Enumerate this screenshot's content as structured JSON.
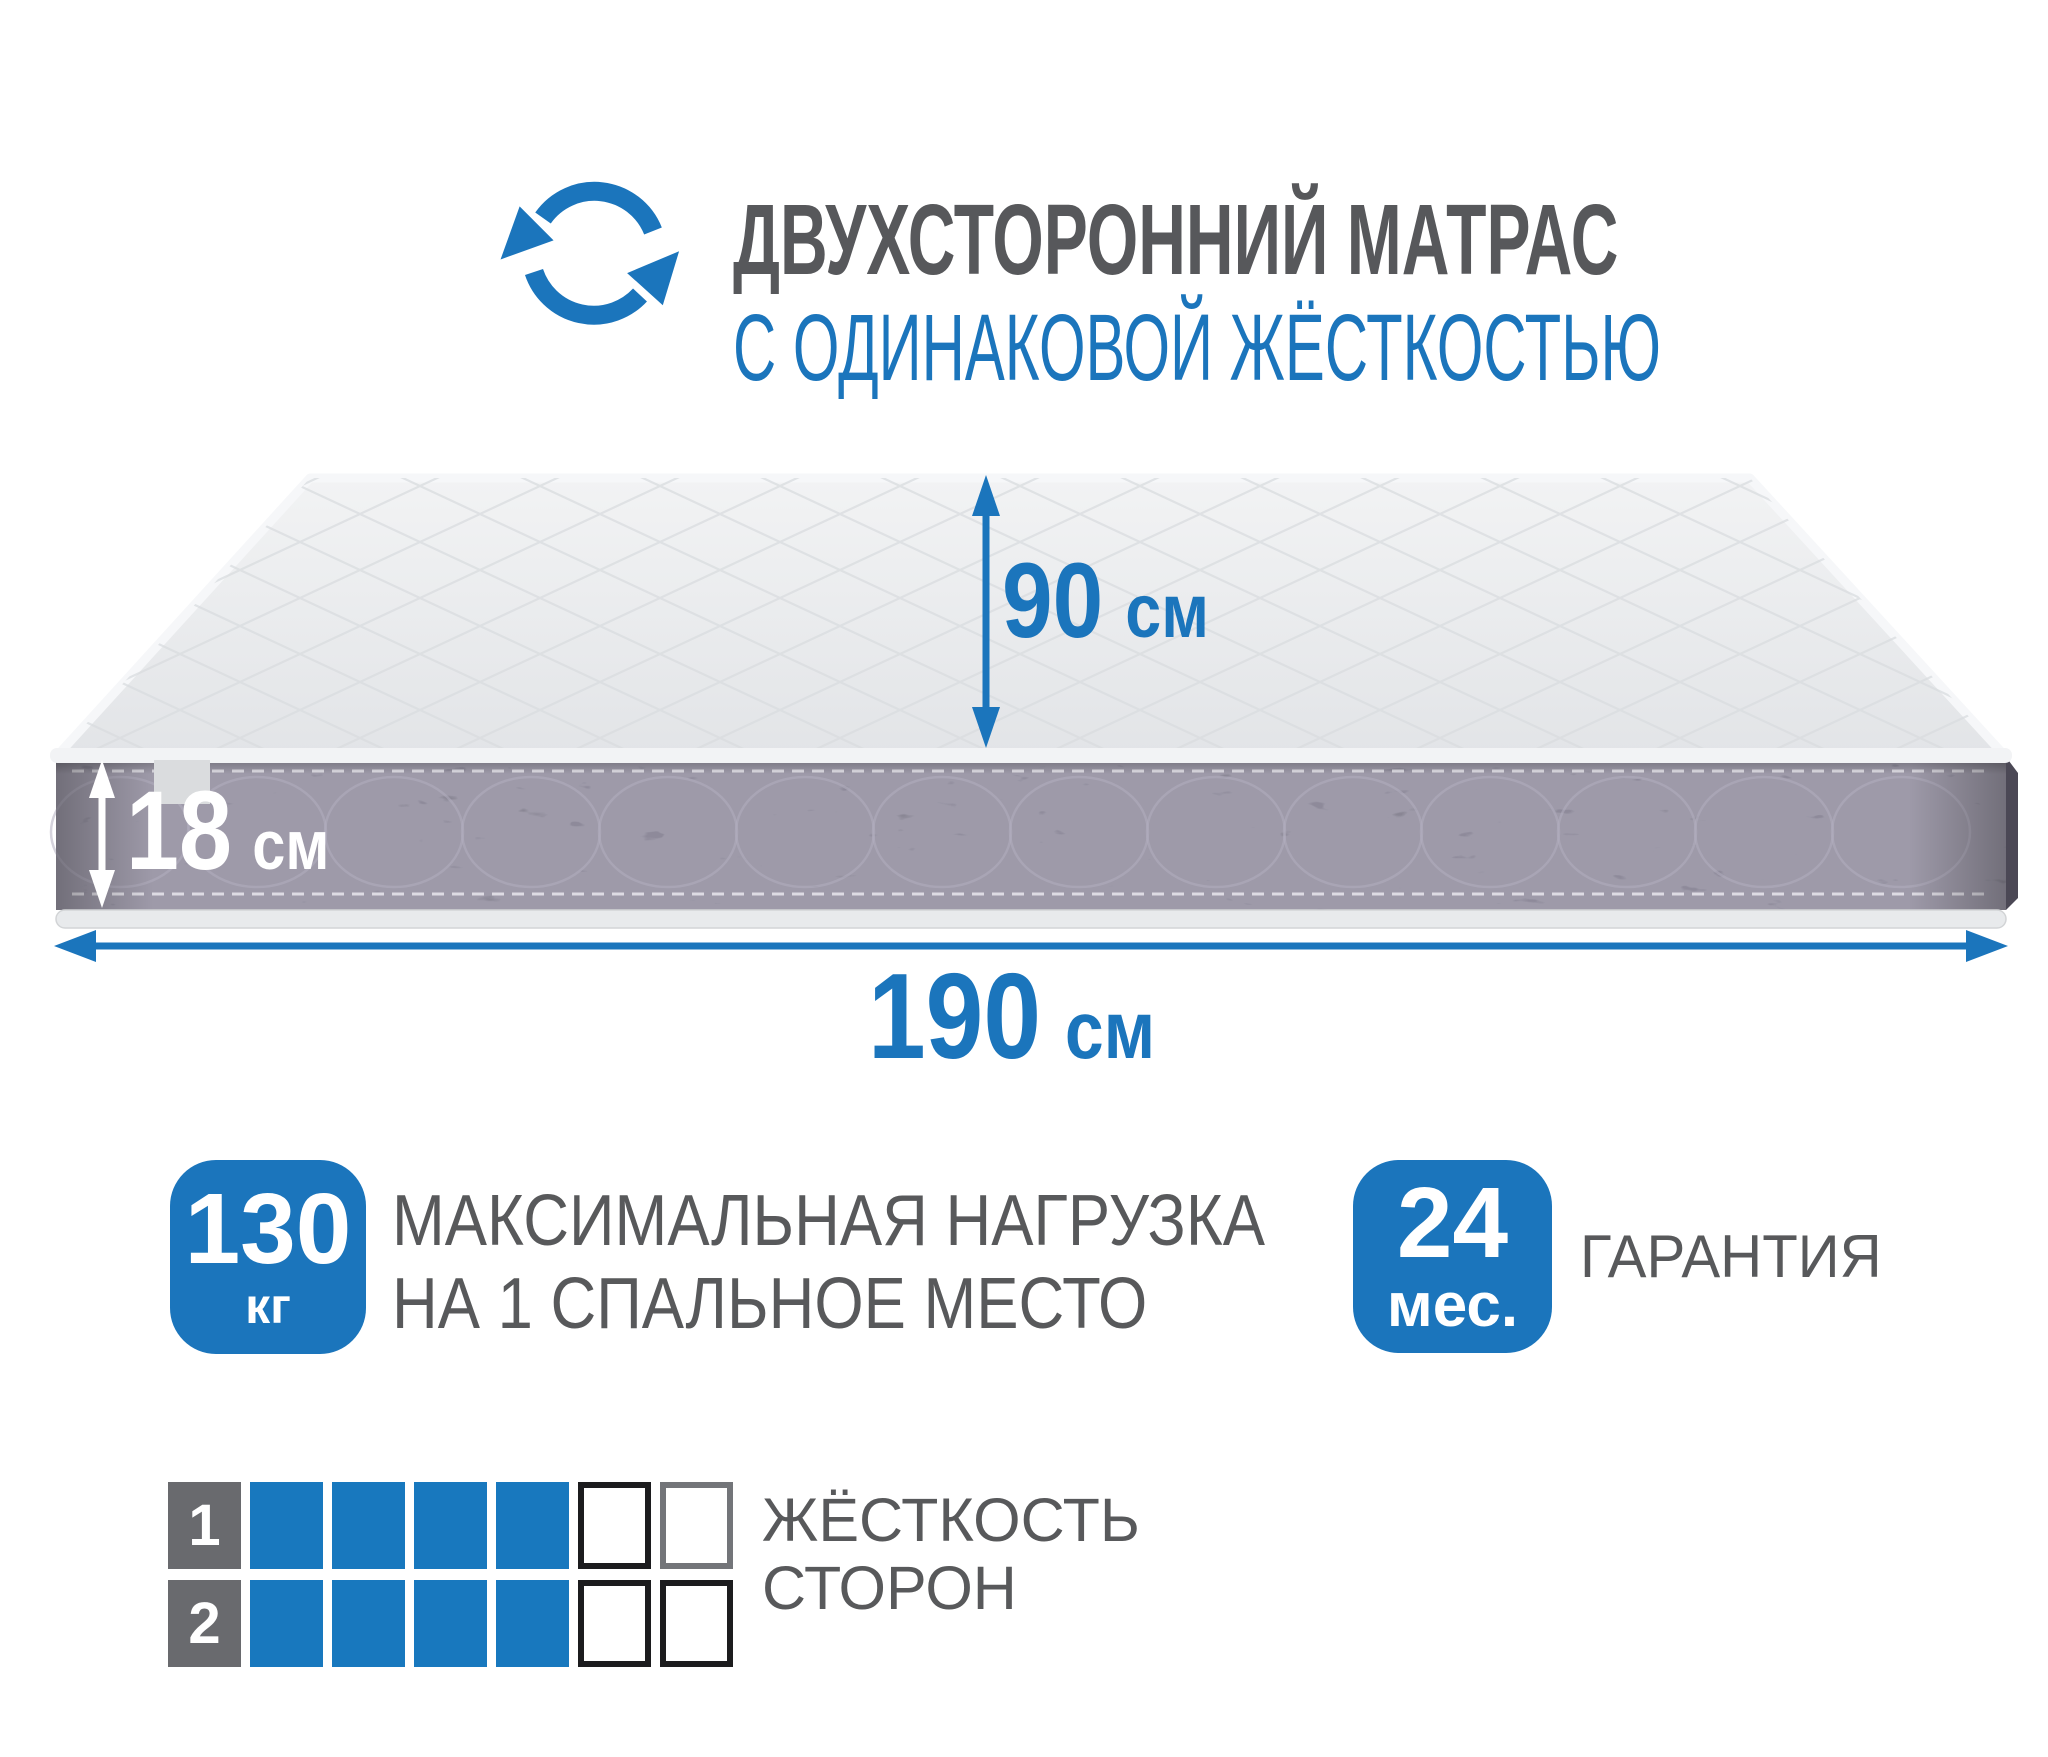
{
  "colors": {
    "accent_blue": "#1b75bc",
    "firmness_filled_blue": "#1878be",
    "text_gray": "#58595b",
    "side_label_gray": "#696a6e",
    "mattress_side_dark": "#5b5765",
    "mattress_top_light": "#e9ebec",
    "empty_cell_border_black": "#1c1c1e",
    "empty_cell_border_gray": "#737579"
  },
  "header": {
    "icon": "rotate-arrows-icon",
    "title": "ДВУХСТОРОННИЙ МАТРАС",
    "subtitle": "С ОДИНАКОВОЙ ЖЁСТКОСТЬЮ"
  },
  "dimensions": {
    "width": {
      "value": "90",
      "unit": "см"
    },
    "height": {
      "value": "18",
      "unit": "см"
    },
    "length": {
      "value": "190",
      "unit": "см"
    }
  },
  "max_load": {
    "value": "130",
    "unit": "кг",
    "label_line1": "МАКСИМАЛЬНАЯ НАГРУЗКА",
    "label_line2": "НА 1 СПАЛЬНОЕ МЕСТО"
  },
  "warranty": {
    "value": "24",
    "unit": "мес.",
    "label": "ГАРАНТИЯ"
  },
  "firmness": {
    "label_line1": "ЖЁСТКОСТЬ",
    "label_line2": "СТОРОН",
    "scale_total": 6,
    "rows": [
      {
        "side": "1",
        "filled": 4,
        "empty_borders": [
          "black",
          "gray"
        ]
      },
      {
        "side": "2",
        "filled": 4,
        "empty_borders": [
          "black",
          "black"
        ]
      }
    ]
  }
}
